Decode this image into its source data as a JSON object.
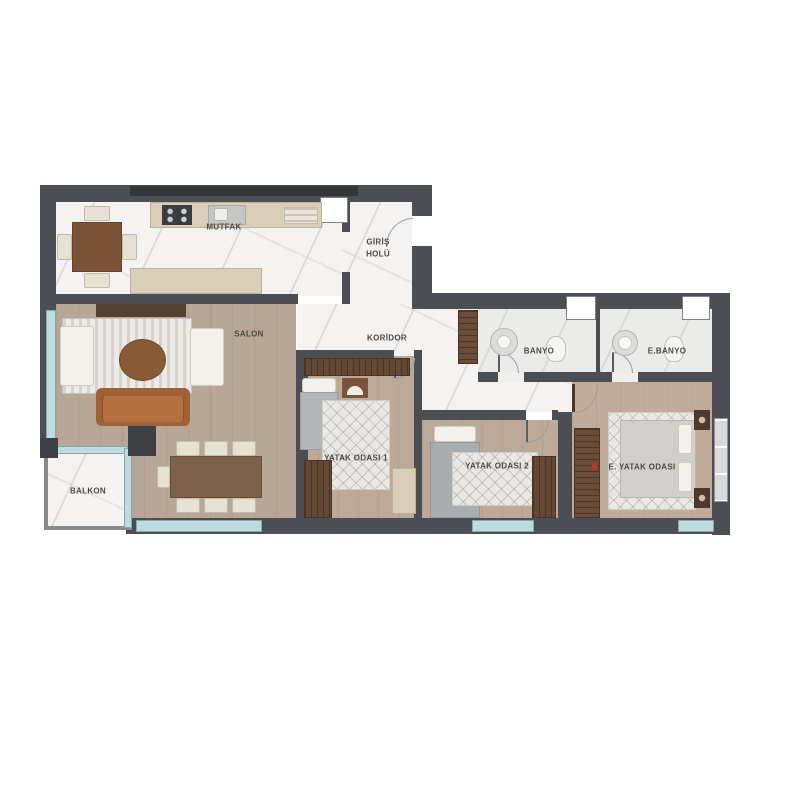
{
  "floorplan": {
    "rooms": {
      "kitchen": {
        "label": "MUTFAK"
      },
      "entrance_hall": {
        "line1": "GİRİŞ",
        "line2": "HOLÜ"
      },
      "living_room": {
        "label": "SALON"
      },
      "corridor": {
        "label": "KORİDOR"
      },
      "bathroom": {
        "label": "BANYO"
      },
      "ensuite_bathroom": {
        "label": "E.BANYO"
      },
      "bedroom_1": {
        "label": "YATAK ODASI 1"
      },
      "bedroom_2": {
        "label": "YATAK ODASI 2"
      },
      "master_bedroom": {
        "label": "E. YATAK ODASI"
      },
      "balcony": {
        "label": "BALKON"
      }
    },
    "colors": {
      "wall": "#4b4e53",
      "wall_dark": "#33363a",
      "marble_floor": "#f4f3f1",
      "bath_floor": "#ebebe9",
      "wood_floor": "#b8a697",
      "glass": "#bedce0",
      "counter_beige": "#d9ceb7",
      "sofa_rust": "#b5703f",
      "table_brown": "#7c5339",
      "wardrobe_brown": "#64483f",
      "label_text": "#4e4a44",
      "marker_red": "#b23a28"
    }
  }
}
